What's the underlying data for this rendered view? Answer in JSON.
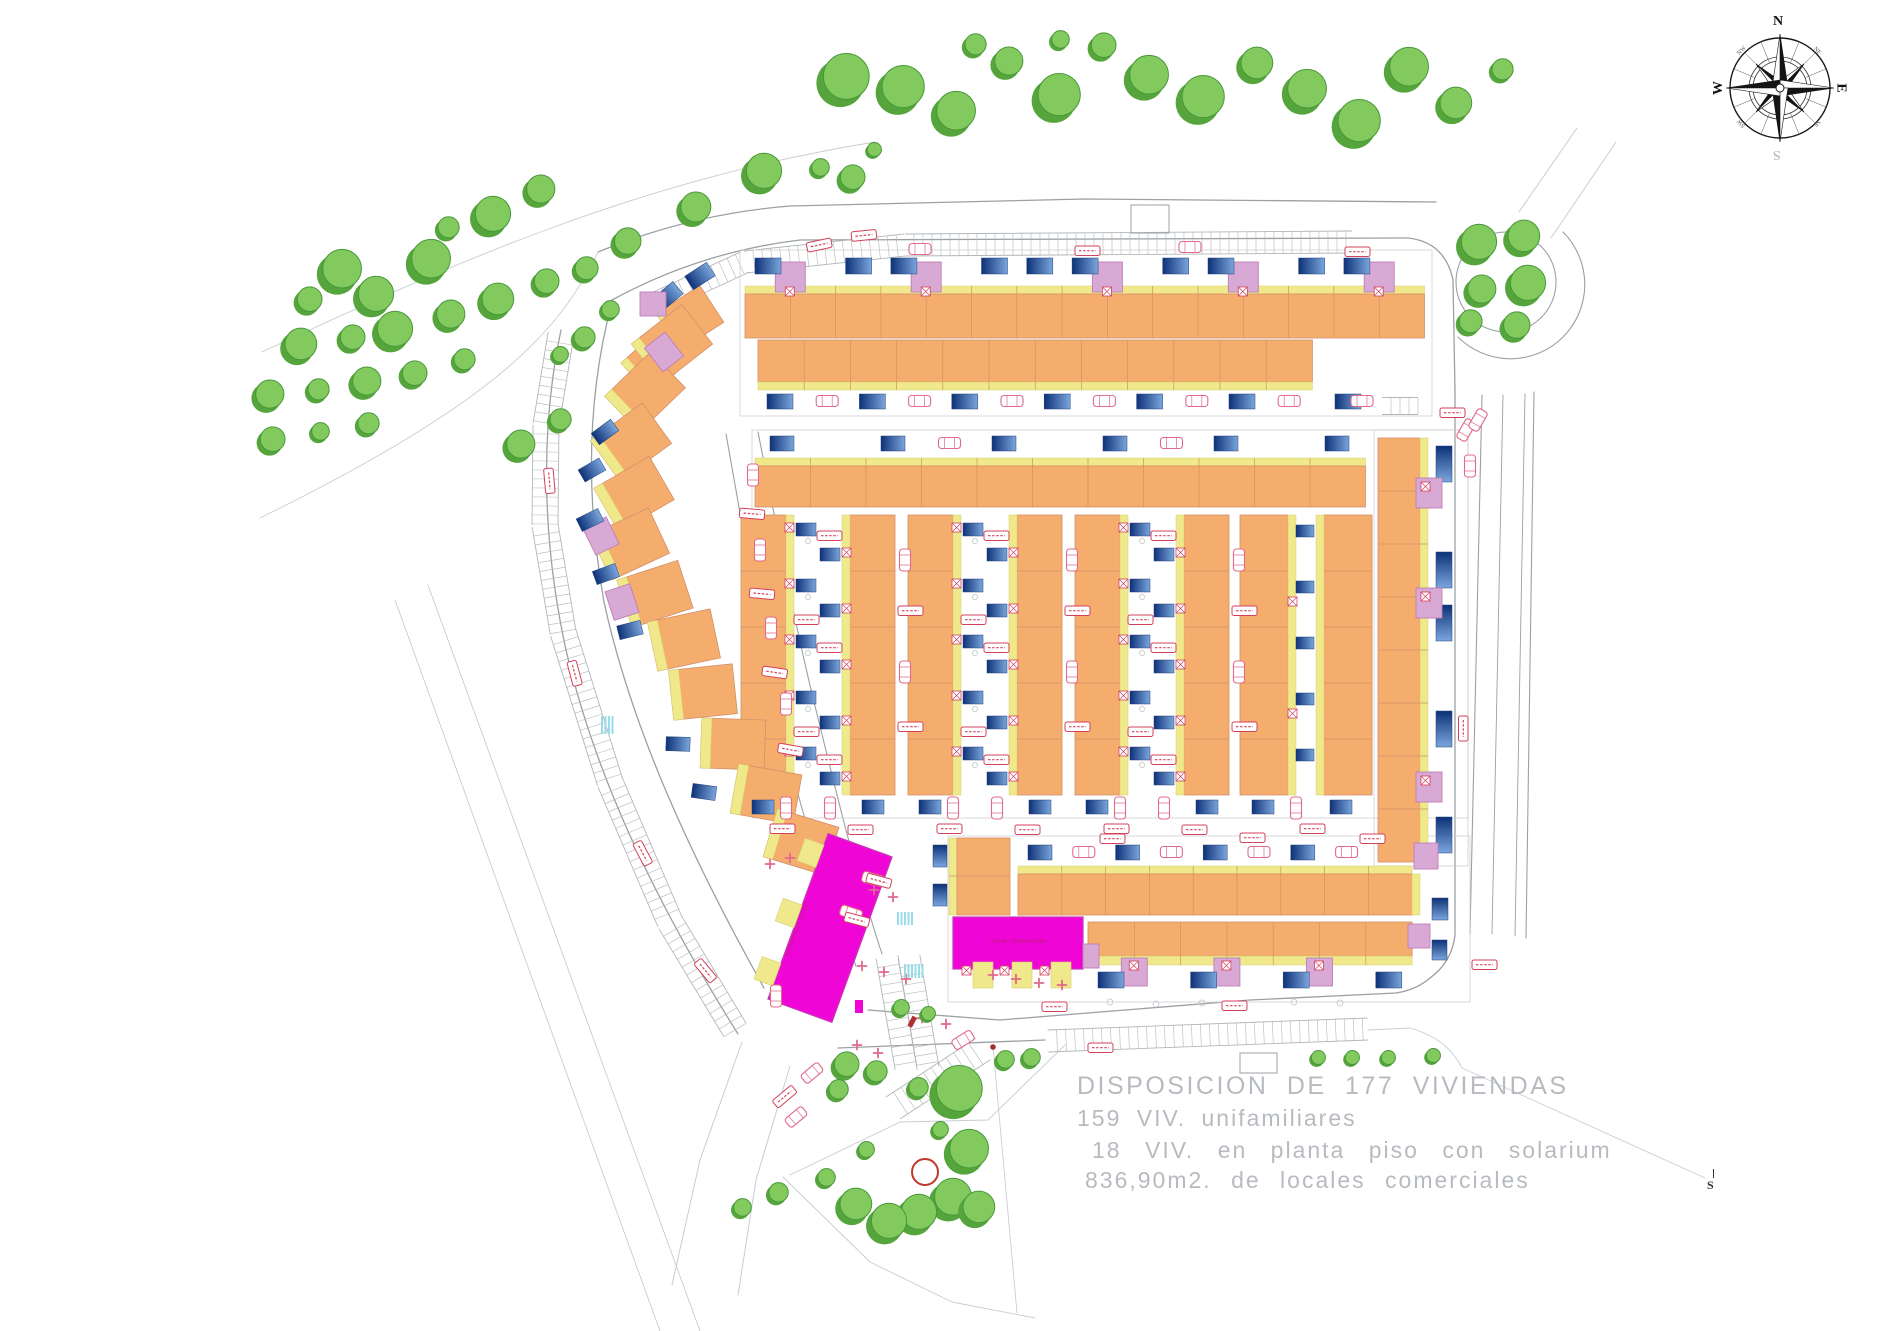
{
  "legend": {
    "line1": "DISPOSICION DE 177 VIVIENDAS",
    "line2": "159 VIV. unifamiliares",
    "line3": "18 VIV. en planta piso con solarium",
    "line4": "836,90m2. de locales comerciales"
  },
  "stats": {
    "total_viviendas": 177,
    "viviendas_unifamiliares": 159,
    "viviendas_en_planta_piso_con_solarium": 18,
    "locales_comerciales_m2": "836,90"
  },
  "compass": {
    "n": "N",
    "e": "E",
    "s": "S",
    "w": "W",
    "ne": "NE",
    "se": "SE",
    "sw": "SW",
    "nw": "NW"
  },
  "scale_mark": "S",
  "commercial_buildings": [
    {
      "label": "LOCAL COMERCIAL"
    },
    {
      "label": "LOCAL COMERCIAL"
    }
  ],
  "palette": {
    "house_orange": "#f5ad6e",
    "house_orange_stroke": "#d2906a",
    "garden_yellow": "#efe98c",
    "garden_yellow_stroke": "#d8cf6a",
    "addition_purple": "#d9a9d6",
    "addition_purple_stroke": "#bd7fb5",
    "pool_dark": "#0e3178",
    "pool_light": "#7aa6dc",
    "commercial_magenta": "#ef06d6",
    "commercial_magenta_stroke": "#c837b8",
    "tree_fill": "#82ca5e",
    "tree_shadow": "#55a53c",
    "tree_stroke": "#47973a",
    "road_gray": "#9aa0a4",
    "faint_gray": "#c9cdd0",
    "car_pink": "#e06a8a",
    "symbol_red": "#d3405a",
    "legend_text": "#b7bbc0",
    "crosswalk_cyan": "#9adbe8",
    "highlight_red_circle": "#c0392b"
  }
}
